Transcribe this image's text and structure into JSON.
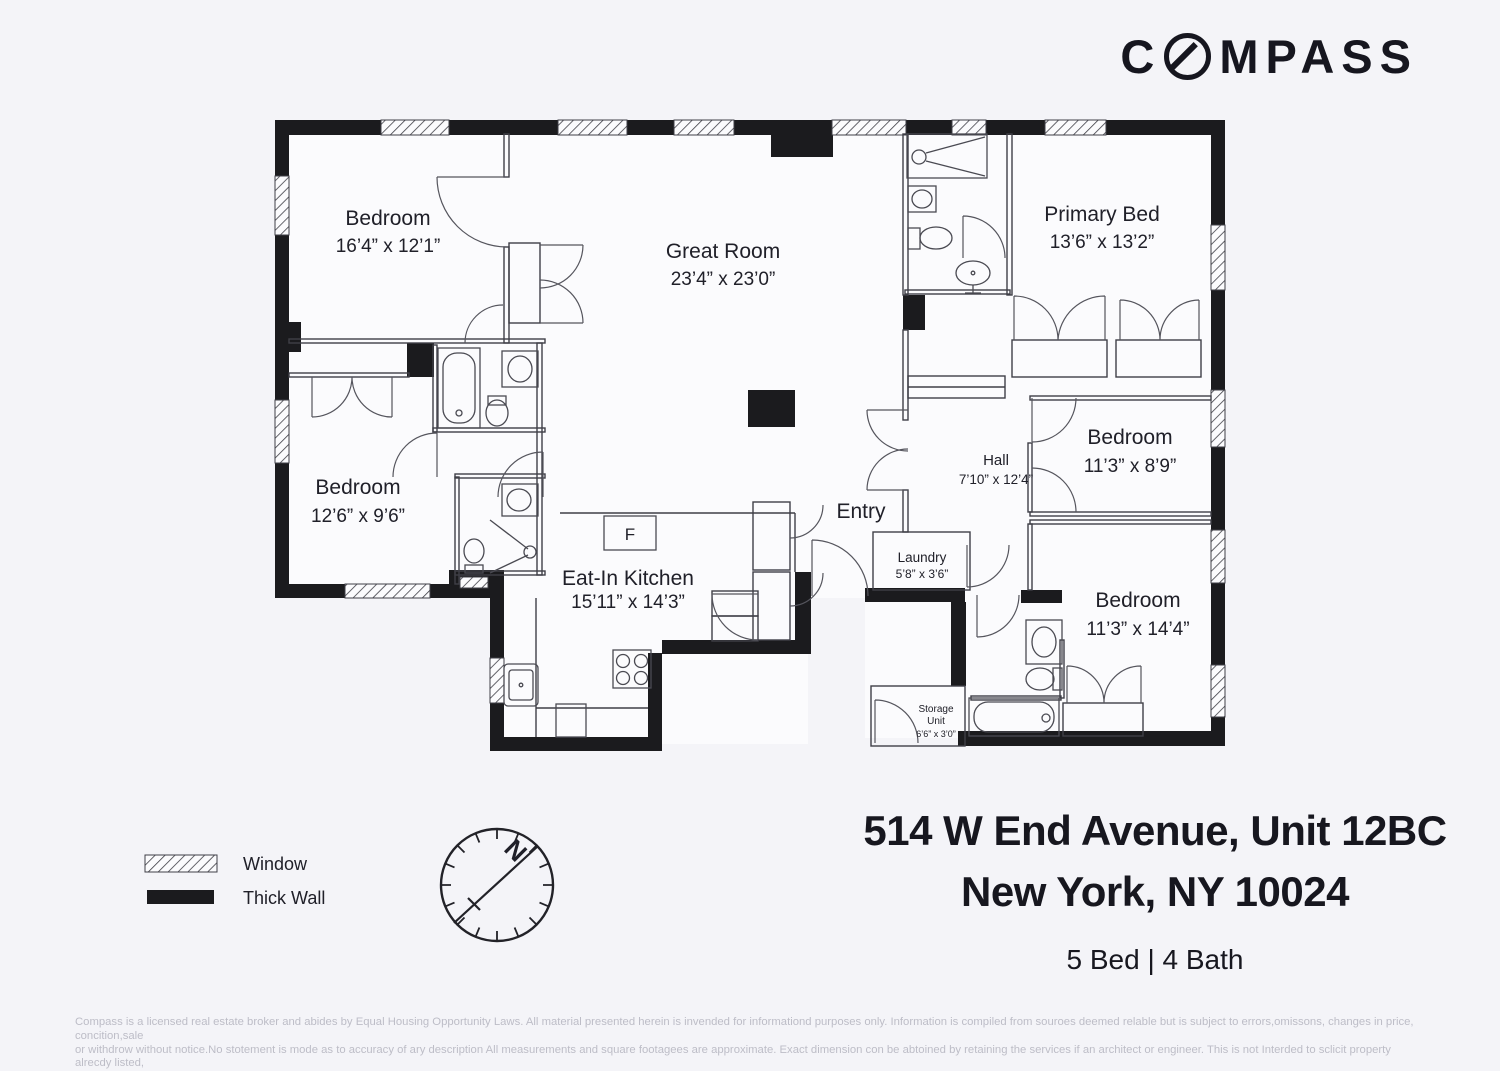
{
  "logo": {
    "pre": "C",
    "post": "MPASS",
    "alt": "COMPASS"
  },
  "floorplan": {
    "rooms": {
      "bedroom_top_left": {
        "name": "Bedroom",
        "dims": "16’4” x 12’1”"
      },
      "great_room": {
        "name": "Great Room",
        "dims": "23’4” x 23’0”"
      },
      "primary_bed": {
        "name": "Primary Bed",
        "dims": "13’6” x 13’2”"
      },
      "bedroom_mid_left": {
        "name": "Bedroom",
        "dims": "12’6” x 9’6”"
      },
      "hall": {
        "name": "Hall",
        "dims": "7’10” x 12’4”"
      },
      "bedroom_mid_right": {
        "name": "Bedroom",
        "dims": "11’3” x 8’9”"
      },
      "entry": {
        "name": "Entry"
      },
      "laundry": {
        "name": "Laundry",
        "dims": "5’8” x 3’6”"
      },
      "eat_in_kitchen": {
        "name": "Eat-In Kitchen",
        "dims": "15’11” x 14’3”"
      },
      "bedroom_bottom_right": {
        "name": "Bedroom",
        "dims": "11’3” x 14’4”"
      },
      "storage": {
        "name_line1": "Storage",
        "name_line2": "Unit",
        "dims": "6’6” x 3’0”"
      },
      "fridge_label": "F"
    },
    "compass_rose": {
      "north": "N"
    }
  },
  "legend": {
    "window": "Window",
    "thick_wall": "Thick Wall"
  },
  "address": {
    "line1": "514 W End Avenue, Unit 12BC",
    "line2": "New York, NY 10024",
    "beds_baths": "5 Bed | 4 Bath"
  },
  "disclaimer": {
    "line1": "Compass is a licensed real estate broker and abides by Equal Housing Opportunity Laws. All material presented herein is invended for informationd purposes only. Information is compiled from souroes deemed relable but is subject to errors,omissons, changes in price, concition,sale",
    "line2": "or withdrow without notice.No stotement is mode as to accuracy of ary description All measurements and square footagees are approximate. Exact dimension con be abtoined by retaining the services if an architect or engineer. This is not Interded to sclicit property alrecdy listed,"
  },
  "colors": {
    "background": "#f4f4f8",
    "wall": "#1b1b1e",
    "brand": "#16161f",
    "muted_text": "#bdbdc7"
  }
}
